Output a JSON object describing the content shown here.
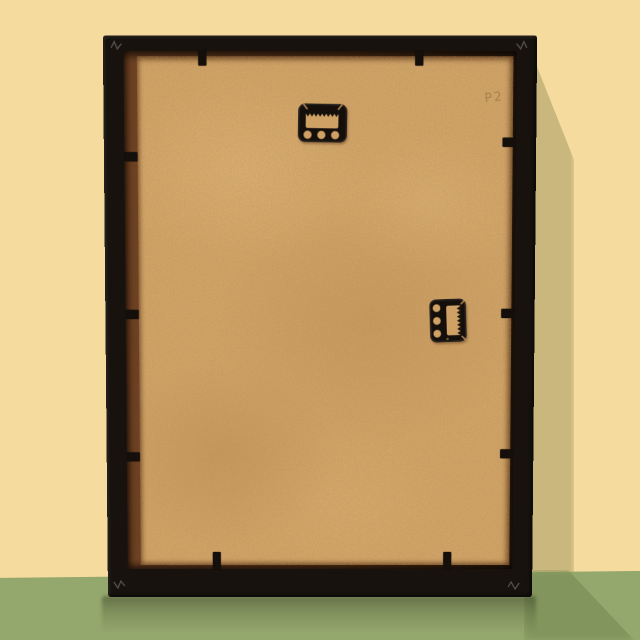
{
  "scene": {
    "type": "photograph",
    "description": "Back view of a black picture frame with a tan MDF backing board, leaning against a pale yellow wall on a glossy green surface; soft shadow cast to the right and a faint reflection below",
    "faint_marking": "P2",
    "colors": {
      "wall": "#f5dc9e",
      "wall_shadow": "#c9b77d",
      "floor": "#94a76c",
      "floor_shadow": "#5f7540",
      "frame_black": "#17120e",
      "rabbet_brown": "#6e4223",
      "backing_tan": "#cfa164",
      "hardware_black": "#140f0b"
    }
  },
  "frame": {
    "material": "black wood",
    "backing": "tan MDF hardboard",
    "hardware": [
      {
        "name": "sawtooth-hanger-top",
        "orientation": "portrait hanging",
        "holes": 3
      },
      {
        "name": "sawtooth-hanger-side",
        "orientation": "landscape hanging",
        "holes": 3
      }
    ],
    "retainer_clips": {
      "top": 2,
      "bottom": 2,
      "left": 3,
      "right": 3
    },
    "corner_staples": 4
  }
}
